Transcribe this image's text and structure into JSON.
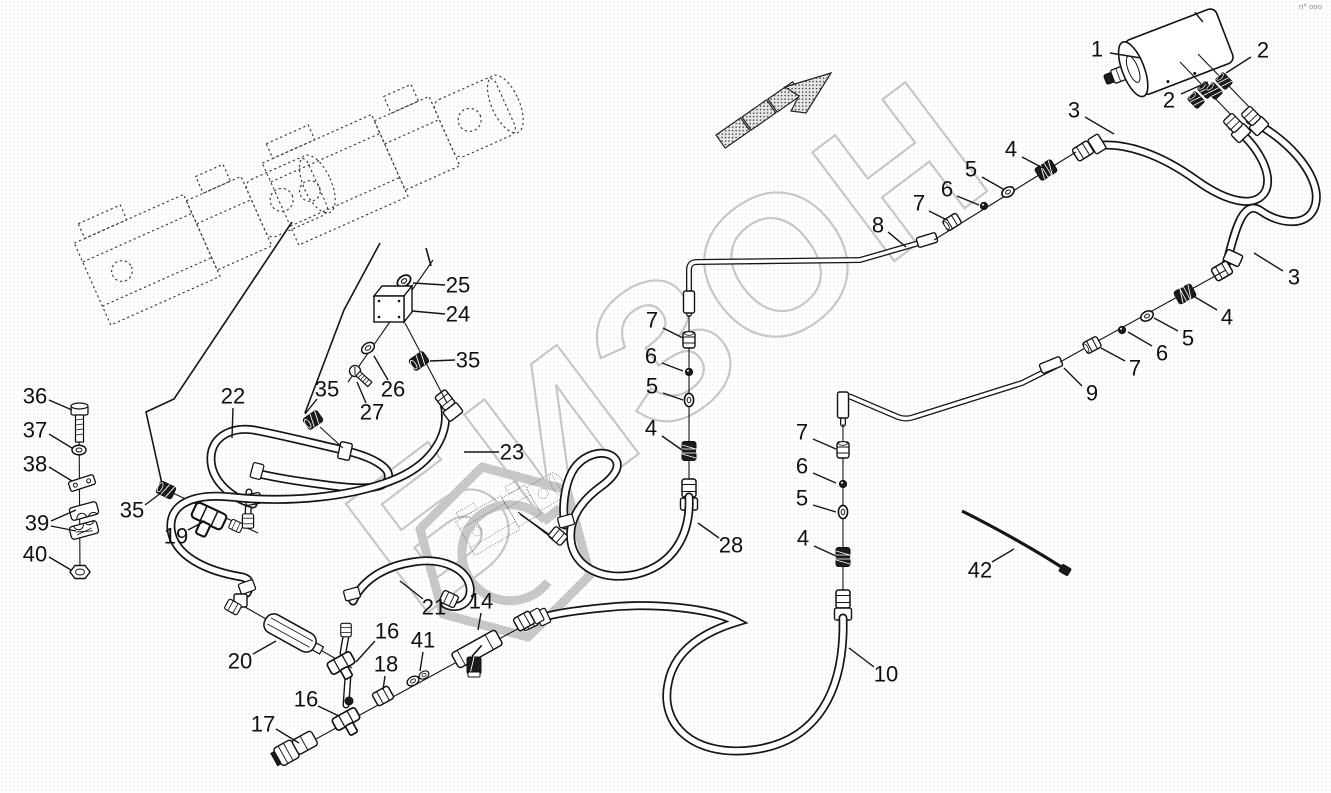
{
  "diagram": {
    "background": "#ffffff",
    "line_color": "#151515",
    "watermark": {
      "text": "БИЗОН",
      "color": "#c7c7c7"
    },
    "corner_mark": "п° ооо",
    "callouts": [
      {
        "n": "1",
        "x": 1097,
        "y": 49,
        "leads": [
          [
            1110,
            53,
            1141,
            58
          ]
        ]
      },
      {
        "n": "2",
        "x": 1263,
        "y": 50,
        "leads": [
          [
            1251,
            57,
            1226,
            73
          ]
        ]
      },
      {
        "n": "2",
        "x": 1169,
        "y": 100,
        "leads": [
          [
            1181,
            94,
            1208,
            82
          ]
        ]
      },
      {
        "n": "3",
        "x": 1074,
        "y": 110,
        "leads": [
          [
            1085,
            117,
            1114,
            134
          ]
        ]
      },
      {
        "n": "3",
        "x": 1294,
        "y": 277,
        "leads": [
          [
            1283,
            271,
            1254,
            253
          ]
        ]
      },
      {
        "n": "4",
        "x": 1011,
        "y": 149,
        "leads": [
          [
            1022,
            157,
            1043,
            168
          ]
        ]
      },
      {
        "n": "5",
        "x": 971,
        "y": 169,
        "leads": [
          [
            982,
            177,
            1003,
            189
          ]
        ]
      },
      {
        "n": "6",
        "x": 947,
        "y": 189,
        "leads": [
          [
            957,
            196,
            979,
            205
          ]
        ]
      },
      {
        "n": "7",
        "x": 919,
        "y": 203,
        "leads": [
          [
            929,
            211,
            947,
            220
          ]
        ]
      },
      {
        "n": "8",
        "x": 878,
        "y": 225,
        "leads": [
          [
            888,
            232,
            906,
            247
          ]
        ]
      },
      {
        "n": "4",
        "x": 1227,
        "y": 317,
        "leads": [
          [
            1217,
            310,
            1195,
            297
          ]
        ]
      },
      {
        "n": "5",
        "x": 1188,
        "y": 338,
        "leads": [
          [
            1178,
            331,
            1154,
            318
          ]
        ]
      },
      {
        "n": "6",
        "x": 1162,
        "y": 353,
        "leads": [
          [
            1152,
            346,
            1128,
            332
          ]
        ]
      },
      {
        "n": "7",
        "x": 1135,
        "y": 368,
        "leads": [
          [
            1125,
            361,
            1101,
            348
          ]
        ]
      },
      {
        "n": "9",
        "x": 1092,
        "y": 393,
        "leads": [
          [
            1082,
            386,
            1064,
            368
          ]
        ]
      },
      {
        "n": "7",
        "x": 652,
        "y": 320,
        "leads": [
          [
            663,
            328,
            683,
            338
          ]
        ]
      },
      {
        "n": "6",
        "x": 651,
        "y": 356,
        "leads": [
          [
            662,
            363,
            683,
            371
          ]
        ]
      },
      {
        "n": "5",
        "x": 652,
        "y": 386,
        "leads": [
          [
            663,
            393,
            683,
            400
          ]
        ]
      },
      {
        "n": "4",
        "x": 651,
        "y": 428,
        "leads": [
          [
            662,
            436,
            682,
            450
          ]
        ]
      },
      {
        "n": "28",
        "x": 731,
        "y": 545,
        "leads": [
          [
            719,
            538,
            698,
            523
          ]
        ]
      },
      {
        "n": "7",
        "x": 802,
        "y": 432,
        "leads": [
          [
            813,
            439,
            836,
            449
          ]
        ]
      },
      {
        "n": "6",
        "x": 802,
        "y": 466,
        "leads": [
          [
            813,
            473,
            836,
            483
          ]
        ]
      },
      {
        "n": "5",
        "x": 802,
        "y": 498,
        "leads": [
          [
            813,
            505,
            836,
            512
          ]
        ]
      },
      {
        "n": "4",
        "x": 803,
        "y": 538,
        "leads": [
          [
            814,
            546,
            836,
            556
          ]
        ]
      },
      {
        "n": "10",
        "x": 886,
        "y": 674,
        "leads": [
          [
            874,
            667,
            849,
            648
          ]
        ]
      },
      {
        "n": "42",
        "x": 980,
        "y": 570,
        "leads": [
          [
            992,
            562,
            1014,
            549
          ]
        ]
      },
      {
        "n": "36",
        "x": 35,
        "y": 396,
        "leads": [
          [
            49,
            400,
            72,
            410
          ]
        ]
      },
      {
        "n": "37",
        "x": 35,
        "y": 430,
        "leads": [
          [
            49,
            434,
            72,
            448
          ]
        ]
      },
      {
        "n": "38",
        "x": 35,
        "y": 464,
        "leads": [
          [
            49,
            467,
            72,
            481
          ]
        ]
      },
      {
        "n": "39",
        "x": 37,
        "y": 523,
        "leads": [
          [
            51,
            521,
            76,
            510
          ],
          [
            51,
            526,
            76,
            531
          ]
        ]
      },
      {
        "n": "40",
        "x": 35,
        "y": 554,
        "leads": [
          [
            49,
            557,
            71,
            570
          ]
        ]
      },
      {
        "n": "35",
        "x": 132,
        "y": 510,
        "leads": [
          [
            145,
            505,
            161,
            493
          ]
        ]
      },
      {
        "n": "19",
        "x": 176,
        "y": 536,
        "leads": [
          [
            188,
            530,
            205,
            521
          ]
        ]
      },
      {
        "n": "22",
        "x": 233,
        "y": 396,
        "leads": [
          [
            233,
            408,
            232,
            438
          ]
        ]
      },
      {
        "n": "23",
        "x": 512,
        "y": 452,
        "leads": [
          [
            499,
            452,
            464,
            452
          ]
        ]
      },
      {
        "n": "35",
        "x": 327,
        "y": 389,
        "leads": [
          [
            317,
            399,
            305,
            414
          ]
        ]
      },
      {
        "n": "26",
        "x": 393,
        "y": 389,
        "leads": [
          [
            388,
            380,
            374,
            356
          ]
        ]
      },
      {
        "n": "27",
        "x": 372,
        "y": 412,
        "leads": [
          [
            366,
            403,
            357,
            382
          ]
        ]
      },
      {
        "n": "25",
        "x": 458,
        "y": 285,
        "leads": [
          [
            445,
            285,
            413,
            283
          ]
        ]
      },
      {
        "n": "24",
        "x": 458,
        "y": 314,
        "leads": [
          [
            445,
            314,
            412,
            311
          ]
        ]
      },
      {
        "n": "35",
        "x": 468,
        "y": 360,
        "leads": [
          [
            455,
            360,
            430,
            361
          ]
        ]
      },
      {
        "n": "20",
        "x": 240,
        "y": 661,
        "leads": [
          [
            253,
            654,
            276,
            641
          ]
        ]
      },
      {
        "n": "21",
        "x": 434,
        "y": 607,
        "leads": [
          [
            423,
            599,
            400,
            581
          ]
        ]
      },
      {
        "n": "16",
        "x": 387,
        "y": 631,
        "leads": [
          [
            375,
            641,
            356,
            662
          ]
        ]
      },
      {
        "n": "18",
        "x": 386,
        "y": 664,
        "leads": [
          [
            385,
            676,
            383,
            690
          ]
        ]
      },
      {
        "n": "41",
        "x": 423,
        "y": 640,
        "leads": [
          [
            423,
            652,
            420,
            671
          ]
        ]
      },
      {
        "n": "14",
        "x": 481,
        "y": 601,
        "leads": [
          [
            481,
            613,
            478,
            630
          ]
        ]
      },
      {
        "n": "16",
        "x": 306,
        "y": 699,
        "leads": [
          [
            318,
            706,
            339,
            716
          ]
        ]
      },
      {
        "n": "17",
        "x": 263,
        "y": 724,
        "leads": [
          [
            276,
            729,
            299,
            743
          ]
        ]
      }
    ]
  }
}
